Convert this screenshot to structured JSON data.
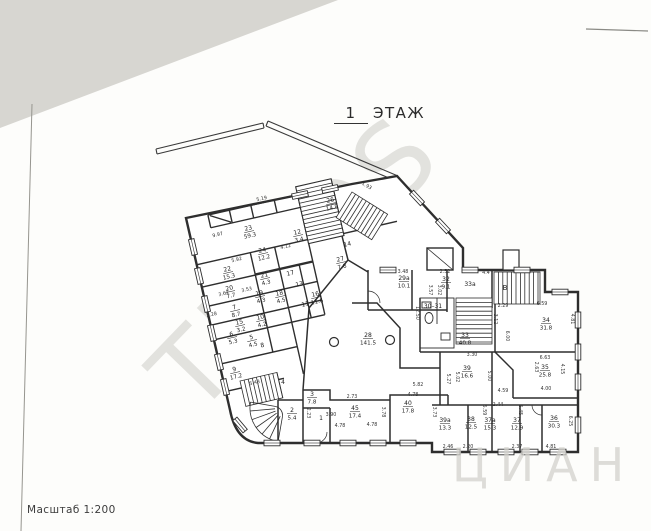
{
  "page": {
    "title_number": "1",
    "title_word": "ЭТАЖ",
    "scale_label": "Масштаб 1:200",
    "watermark_main": "TELOS",
    "watermark_corner": "ЦИАН",
    "paper_color": "#fdfdfb",
    "scan_corner_color": "#d7d6d1",
    "wall_color": "#2e2e2e"
  },
  "plan": {
    "stair_letter": "В",
    "rooms": [
      {
        "n": "23",
        "a": "59.3",
        "x": 249,
        "y": 231,
        "r": -13
      },
      {
        "n": "22",
        "a": "15.3",
        "x": 228,
        "y": 272,
        "r": -13
      },
      {
        "n": "24",
        "a": "12.2",
        "x": 263,
        "y": 253,
        "r": -13
      },
      {
        "n": "26",
        "a": "14.8",
        "x": 331,
        "y": 203,
        "r": -13
      },
      {
        "n": "12",
        "a": "3.4",
        "x": 298,
        "y": 235,
        "r": -13
      },
      {
        "n": "14",
        "a": "",
        "x": 348,
        "y": 247,
        "r": -13
      },
      {
        "n": "27",
        "a": "7.8",
        "x": 341,
        "y": 262,
        "r": -13
      },
      {
        "n": "21",
        "a": "4.3",
        "x": 265,
        "y": 278,
        "r": -13
      },
      {
        "n": "17",
        "a": "",
        "x": 291,
        "y": 276,
        "r": -13
      },
      {
        "n": "13",
        "a": "",
        "x": 300,
        "y": 287,
        "r": -13
      },
      {
        "n": "19",
        "a": "4.3",
        "x": 260,
        "y": 296,
        "r": -13
      },
      {
        "n": "18",
        "a": "4.5",
        "x": 280,
        "y": 296,
        "r": -13
      },
      {
        "n": "11",
        "a": "",
        "x": 306,
        "y": 307,
        "r": -13
      },
      {
        "n": "16",
        "a": "11.6",
        "x": 316,
        "y": 297,
        "r": -13
      },
      {
        "n": "20",
        "a": "7.7",
        "x": 230,
        "y": 291,
        "r": -13
      },
      {
        "n": "7",
        "a": "8.7",
        "x": 235,
        "y": 310,
        "r": -13
      },
      {
        "n": "15",
        "a": "3.2",
        "x": 240,
        "y": 325,
        "r": -13
      },
      {
        "n": "10",
        "a": "4.2",
        "x": 261,
        "y": 320,
        "r": -13
      },
      {
        "n": "5",
        "a": "4.5",
        "x": 252,
        "y": 340,
        "r": -13
      },
      {
        "n": "8",
        "a": "",
        "x": 263,
        "y": 348,
        "r": -13
      },
      {
        "n": "6",
        "a": "5.3",
        "x": 232,
        "y": 337,
        "r": -13
      },
      {
        "n": "9",
        "a": "17.2",
        "x": 235,
        "y": 372,
        "r": -13
      },
      {
        "n": "4",
        "a": "",
        "x": 283,
        "y": 385,
        "r": 0
      },
      {
        "n": "2",
        "a": "5.4",
        "x": 292,
        "y": 413,
        "r": 0
      },
      {
        "n": "3",
        "a": "7.8",
        "x": 312,
        "y": 397,
        "r": 0
      },
      {
        "n": "1",
        "a": "",
        "x": 321,
        "y": 421,
        "r": 0
      },
      {
        "n": "45",
        "a": "17.4",
        "x": 355,
        "y": 411,
        "r": 0
      },
      {
        "n": "40",
        "a": "17.8",
        "x": 408,
        "y": 406,
        "r": 0
      },
      {
        "n": "28",
        "a": "141.5",
        "x": 368,
        "y": 338,
        "r": 0
      },
      {
        "n": "29а",
        "a": "10.1",
        "x": 404,
        "y": 281,
        "r": 0
      },
      {
        "n": "32",
        "a": "9.1",
        "x": 446,
        "y": 282,
        "r": 0
      },
      {
        "n": "33а",
        "a": "",
        "x": 470,
        "y": 287,
        "r": 0
      },
      {
        "n": "30–31",
        "a": "",
        "x": 433,
        "y": 309,
        "r": 0
      },
      {
        "n": "33",
        "a": "40.8",
        "x": 465,
        "y": 338,
        "r": 0
      },
      {
        "n": "34",
        "a": "31.8",
        "x": 546,
        "y": 323,
        "r": 0
      },
      {
        "n": "35",
        "a": "25.8",
        "x": 545,
        "y": 370,
        "r": 0
      },
      {
        "n": "39",
        "a": "16.6",
        "x": 467,
        "y": 371,
        "r": 0
      },
      {
        "n": "39а",
        "a": "13.3",
        "x": 445,
        "y": 423,
        "r": 0
      },
      {
        "n": "38",
        "a": "12.5",
        "x": 471,
        "y": 422,
        "r": 0
      },
      {
        "n": "37а",
        "a": "15.3",
        "x": 490,
        "y": 423,
        "r": 0
      },
      {
        "n": "37",
        "a": "12.9",
        "x": 517,
        "y": 423,
        "r": 0
      },
      {
        "n": "36",
        "a": "30.3",
        "x": 554,
        "y": 421,
        "r": 0
      }
    ],
    "dims": [
      {
        "t": "9.97",
        "x": 218,
        "y": 236,
        "r": -13
      },
      {
        "t": "5.19",
        "x": 262,
        "y": 200,
        "r": -13
      },
      {
        "t": "4.12",
        "x": 286,
        "y": 248,
        "r": -13
      },
      {
        "t": "5.92",
        "x": 237,
        "y": 261,
        "r": -13
      },
      {
        "t": "3.62",
        "x": 224,
        "y": 295,
        "r": -13
      },
      {
        "t": "3.53",
        "x": 247,
        "y": 291,
        "r": -13
      },
      {
        "t": "2.28",
        "x": 212,
        "y": 316,
        "r": -13
      },
      {
        "t": "1.93",
        "x": 366,
        "y": 187,
        "r": 30
      },
      {
        "t": "5.43",
        "x": 255,
        "y": 384,
        "r": -13
      },
      {
        "t": "2.73",
        "x": 352,
        "y": 398,
        "r": 0
      },
      {
        "t": "2.23",
        "x": 307,
        "y": 413,
        "r": 90
      },
      {
        "t": "3.90",
        "x": 331,
        "y": 416,
        "r": 0
      },
      {
        "t": "4.78",
        "x": 340,
        "y": 427,
        "r": 0
      },
      {
        "t": "5.82",
        "x": 418,
        "y": 386,
        "r": 0
      },
      {
        "t": "4.78",
        "x": 413,
        "y": 396,
        "r": 0
      },
      {
        "t": "3.78",
        "x": 382,
        "y": 412,
        "r": 90
      },
      {
        "t": "3.73",
        "x": 433,
        "y": 412,
        "r": 90
      },
      {
        "t": "4.78",
        "x": 372,
        "y": 426,
        "r": 0
      },
      {
        "t": "3.48",
        "x": 403,
        "y": 273,
        "r": 0
      },
      {
        "t": "2.52",
        "x": 445,
        "y": 273,
        "r": 0
      },
      {
        "t": "4.4",
        "x": 486,
        "y": 274,
        "r": 0
      },
      {
        "t": "3.57",
        "x": 429,
        "y": 290,
        "r": 90
      },
      {
        "t": "3.02",
        "x": 438,
        "y": 290,
        "r": 90
      },
      {
        "t": "12.50",
        "x": 416,
        "y": 313,
        "r": 90
      },
      {
        "t": "2.29",
        "x": 503,
        "y": 307,
        "r": 0
      },
      {
        "t": "6.59",
        "x": 542,
        "y": 305,
        "r": 0
      },
      {
        "t": "4.81",
        "x": 571,
        "y": 319,
        "r": 90
      },
      {
        "t": "3.12",
        "x": 494,
        "y": 319,
        "r": 90
      },
      {
        "t": "6.00",
        "x": 506,
        "y": 336,
        "r": 90
      },
      {
        "t": "3.30",
        "x": 472,
        "y": 356,
        "r": 0
      },
      {
        "t": "5.02",
        "x": 456,
        "y": 377,
        "r": 90
      },
      {
        "t": "5.00",
        "x": 488,
        "y": 376,
        "r": 90
      },
      {
        "t": "5.27",
        "x": 447,
        "y": 379,
        "r": 90
      },
      {
        "t": "6.63",
        "x": 545,
        "y": 359,
        "r": 0
      },
      {
        "t": "2.63",
        "x": 535,
        "y": 367,
        "r": 90
      },
      {
        "t": "4.15",
        "x": 561,
        "y": 369,
        "r": 90
      },
      {
        "t": "4.00",
        "x": 546,
        "y": 390,
        "r": 0
      },
      {
        "t": "4.59",
        "x": 503,
        "y": 392,
        "r": 0
      },
      {
        "t": "2.44",
        "x": 498,
        "y": 406,
        "r": 0
      },
      {
        "t": "5.59",
        "x": 483,
        "y": 410,
        "r": 90
      },
      {
        "t": "5.45",
        "x": 519,
        "y": 410,
        "r": 90
      },
      {
        "t": "2.46",
        "x": 448,
        "y": 448,
        "r": 0
      },
      {
        "t": "2.20",
        "x": 468,
        "y": 448,
        "r": 0
      },
      {
        "t": "2.37",
        "x": 517,
        "y": 448,
        "r": 0
      },
      {
        "t": "4.81",
        "x": 551,
        "y": 448,
        "r": 0
      },
      {
        "t": "6.25",
        "x": 569,
        "y": 421,
        "r": 90
      }
    ]
  }
}
